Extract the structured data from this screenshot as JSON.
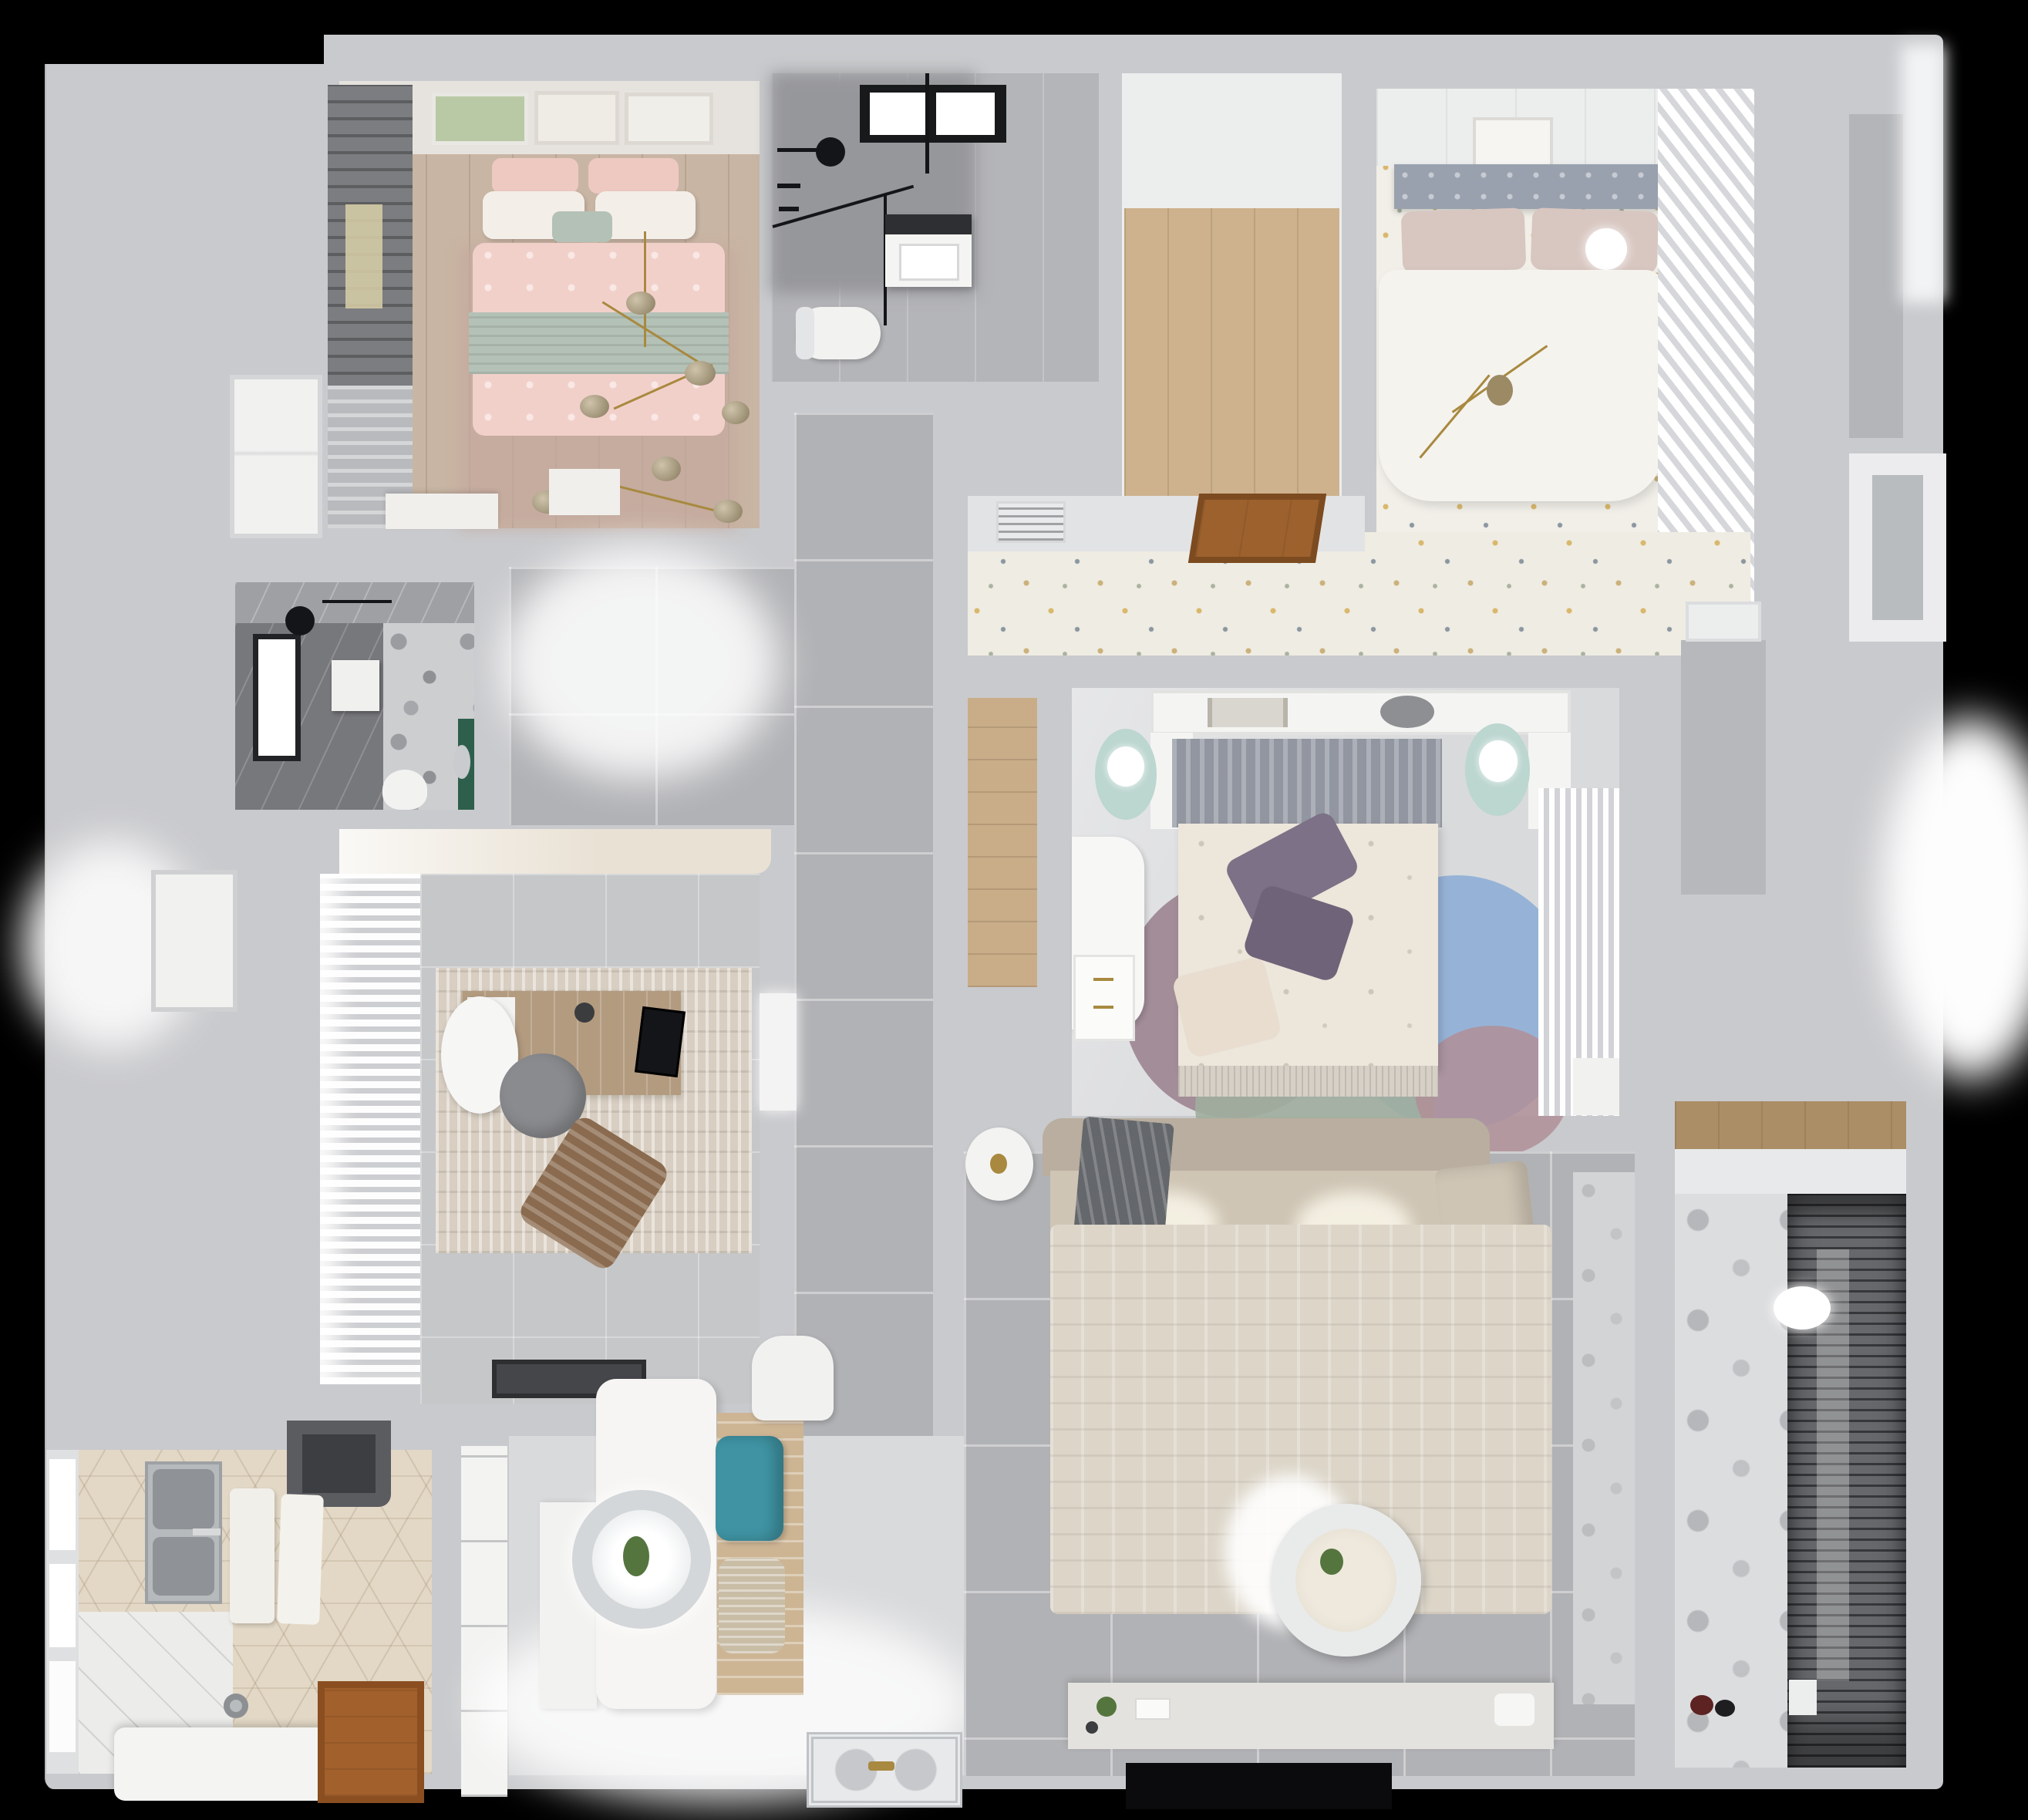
{
  "scene": {
    "description": "photorealistic 3D rendered apartment floor plan, top-down view on black background",
    "background": "#000000"
  },
  "palette": {
    "backdrop": "#b9babd",
    "wall": "#c9cacd",
    "wallLight": "#e2e3e5",
    "woodFloor": "#c9b5a3",
    "artBand": "#e6e3de",
    "curtainDark": "#7c7d80",
    "pinkPillow": "#eec9c2",
    "pillowWhite": "#f3efe8",
    "sageThrow": "#b4c1b6",
    "pinkDuvet": "#f2d0ca",
    "gold": "#a8893f",
    "dresserWhite": "#f0efec",
    "marble": "#b4b5b8",
    "marbleDark": "#96979b",
    "applianceDark": "#2e2f33",
    "fixtureBlack": "#141518",
    "porcelain": "#f2f2f1",
    "closetWood": "#cdb28d",
    "ceilingWhite": "#eceded",
    "masterFloor": "#f1efe8",
    "headboardGray": "#99a1ae",
    "blushPillow": "#d8c6c0",
    "duvetWhite": "#f5f3ee",
    "louverWhite": "#eef0f1",
    "floralFloor": "#efece3",
    "ventWhite": "#e9eaeb",
    "hatchWood": "#9c612d",
    "nicheWood": "#c9ad89",
    "bedroom3Floor": "#d9dadc",
    "mintTable": "#bcd6d0",
    "b3Headboard": "#9196a0",
    "b3Duvet": "#ece6db",
    "purplePillow": "#7c7186",
    "creamPillow": "#e8ddcf",
    "rugBlue": "#8cadd6",
    "rugMauve": "#9b8490",
    "rugSage": "#9fae9e",
    "alcoveFloor": "#b7b8bb",
    "bathDarkTile": "#77787b",
    "terrazzo": "#cdced0",
    "greenAccent": "#2e5f4c",
    "studyTop": "#e9e1d4",
    "studyFloor": "#c6c7c9",
    "studyRug": "#d8cec1",
    "deskWood": "#b39b80",
    "chairGray": "#8a8b8e",
    "loungeBrown": "#8a6b4f",
    "doormat": "#45464a",
    "hexTile": "#e3d8c6",
    "hood": "#5a5c60",
    "steel": "#b7babc",
    "steelDark": "#8f9296",
    "islandWhite": "#f4f4f2",
    "doorBrown": "#a2602c",
    "pantry": "#f3f3f2",
    "diningFloor": "#d9dadb",
    "tableWhite": "#f6f5f3",
    "teal": "#3f93a3",
    "wicker": "#c9bda6",
    "woodMat": "#cdb594",
    "pendantRing": "#d4d7d9",
    "matSilver": "#e8e9ea",
    "livingFloor": "#b1b2b5",
    "sofaSeat": "#cfc5b5",
    "sofaBack": "#b9ae9f",
    "throwGray": "#64676b",
    "livingRug": "#dcd5c8",
    "console": "#e3e2df",
    "tv": "#0b0b0d",
    "balconyFloor": "#d6d7d9",
    "rack": "#66686b",
    "shelfWood": "#ab8e66",
    "glassGray": "#b9bcbf",
    "plantGreen": "#55753f",
    "doorWhite": "#f1f1f0"
  }
}
